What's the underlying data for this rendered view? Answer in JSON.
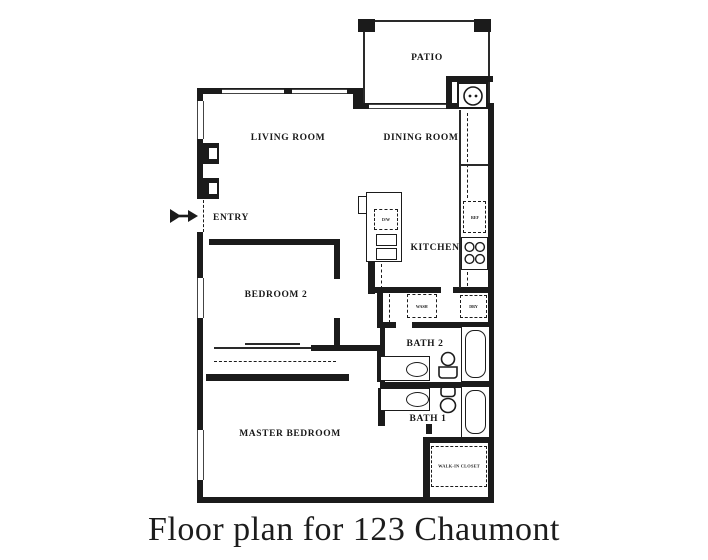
{
  "caption": "Floor plan for 123 Chaumont",
  "rooms": {
    "patio": "PATIO",
    "living": "LIVING ROOM",
    "dining": "DINING ROOM",
    "entry": "ENTRY",
    "kitchen": "KITCHEN",
    "bedroom2": "BEDROOM 2",
    "bath2": "BATH 2",
    "bath1": "BATH 1",
    "master": "MASTER BEDROOM",
    "walkin": "WALK-IN CLOSET"
  },
  "appliances": {
    "dishwasher": "D/W",
    "refrigerator": "REF",
    "washer": "WASH",
    "dryer": "DRY"
  },
  "colors": {
    "ink": "#1b1b1b",
    "paper": "#ffffff"
  }
}
